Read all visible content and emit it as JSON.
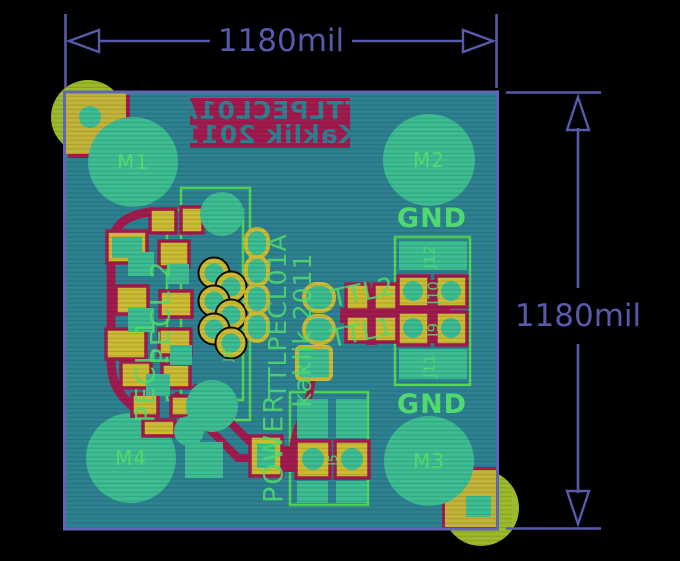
{
  "view": {
    "type": "pcb-layout-render",
    "board_name": "TTLPECL01A"
  },
  "dimensions": {
    "horizontal": "1180mil",
    "vertical": "1180mil"
  },
  "silkscreen_bottom_mirrored": {
    "line1": "TTLPECL01A",
    "line2": "Kaklik 2011"
  },
  "silkscreen_top": {
    "title": "TTLPECL01A",
    "author": "kaklik 2011"
  },
  "mounting_holes": {
    "m1": "M1",
    "m2": "M2",
    "m3": "M3",
    "m4": "M4"
  },
  "net_labels": {
    "gnd_top": "GND",
    "gnd_bottom": "GND",
    "power": "POWER",
    "pecl1": "PECL 1",
    "pecl2": "PECL 2",
    "ttl1": "TTL1",
    "ttl2": "TTL2"
  },
  "ref_designators": {
    "j5": "J5",
    "j8": "J8",
    "j9": "J9",
    "j10": "J10",
    "j11": "J11",
    "j12": "J12"
  },
  "colors": {
    "bg": "#000000",
    "dim": "#575aab",
    "board": "#2d8191",
    "edge": "#6065b5",
    "copper_pad": "#3cbd92",
    "silk_red": "#a11b4e",
    "silk_green": "#50d96e",
    "pad_yellow": "#cbbc33",
    "corner_yellow": "#c2b43a",
    "corner_olive": "#9cba2b",
    "courtyard": "#55dd55",
    "hole_dark": "#0c0c0c"
  }
}
